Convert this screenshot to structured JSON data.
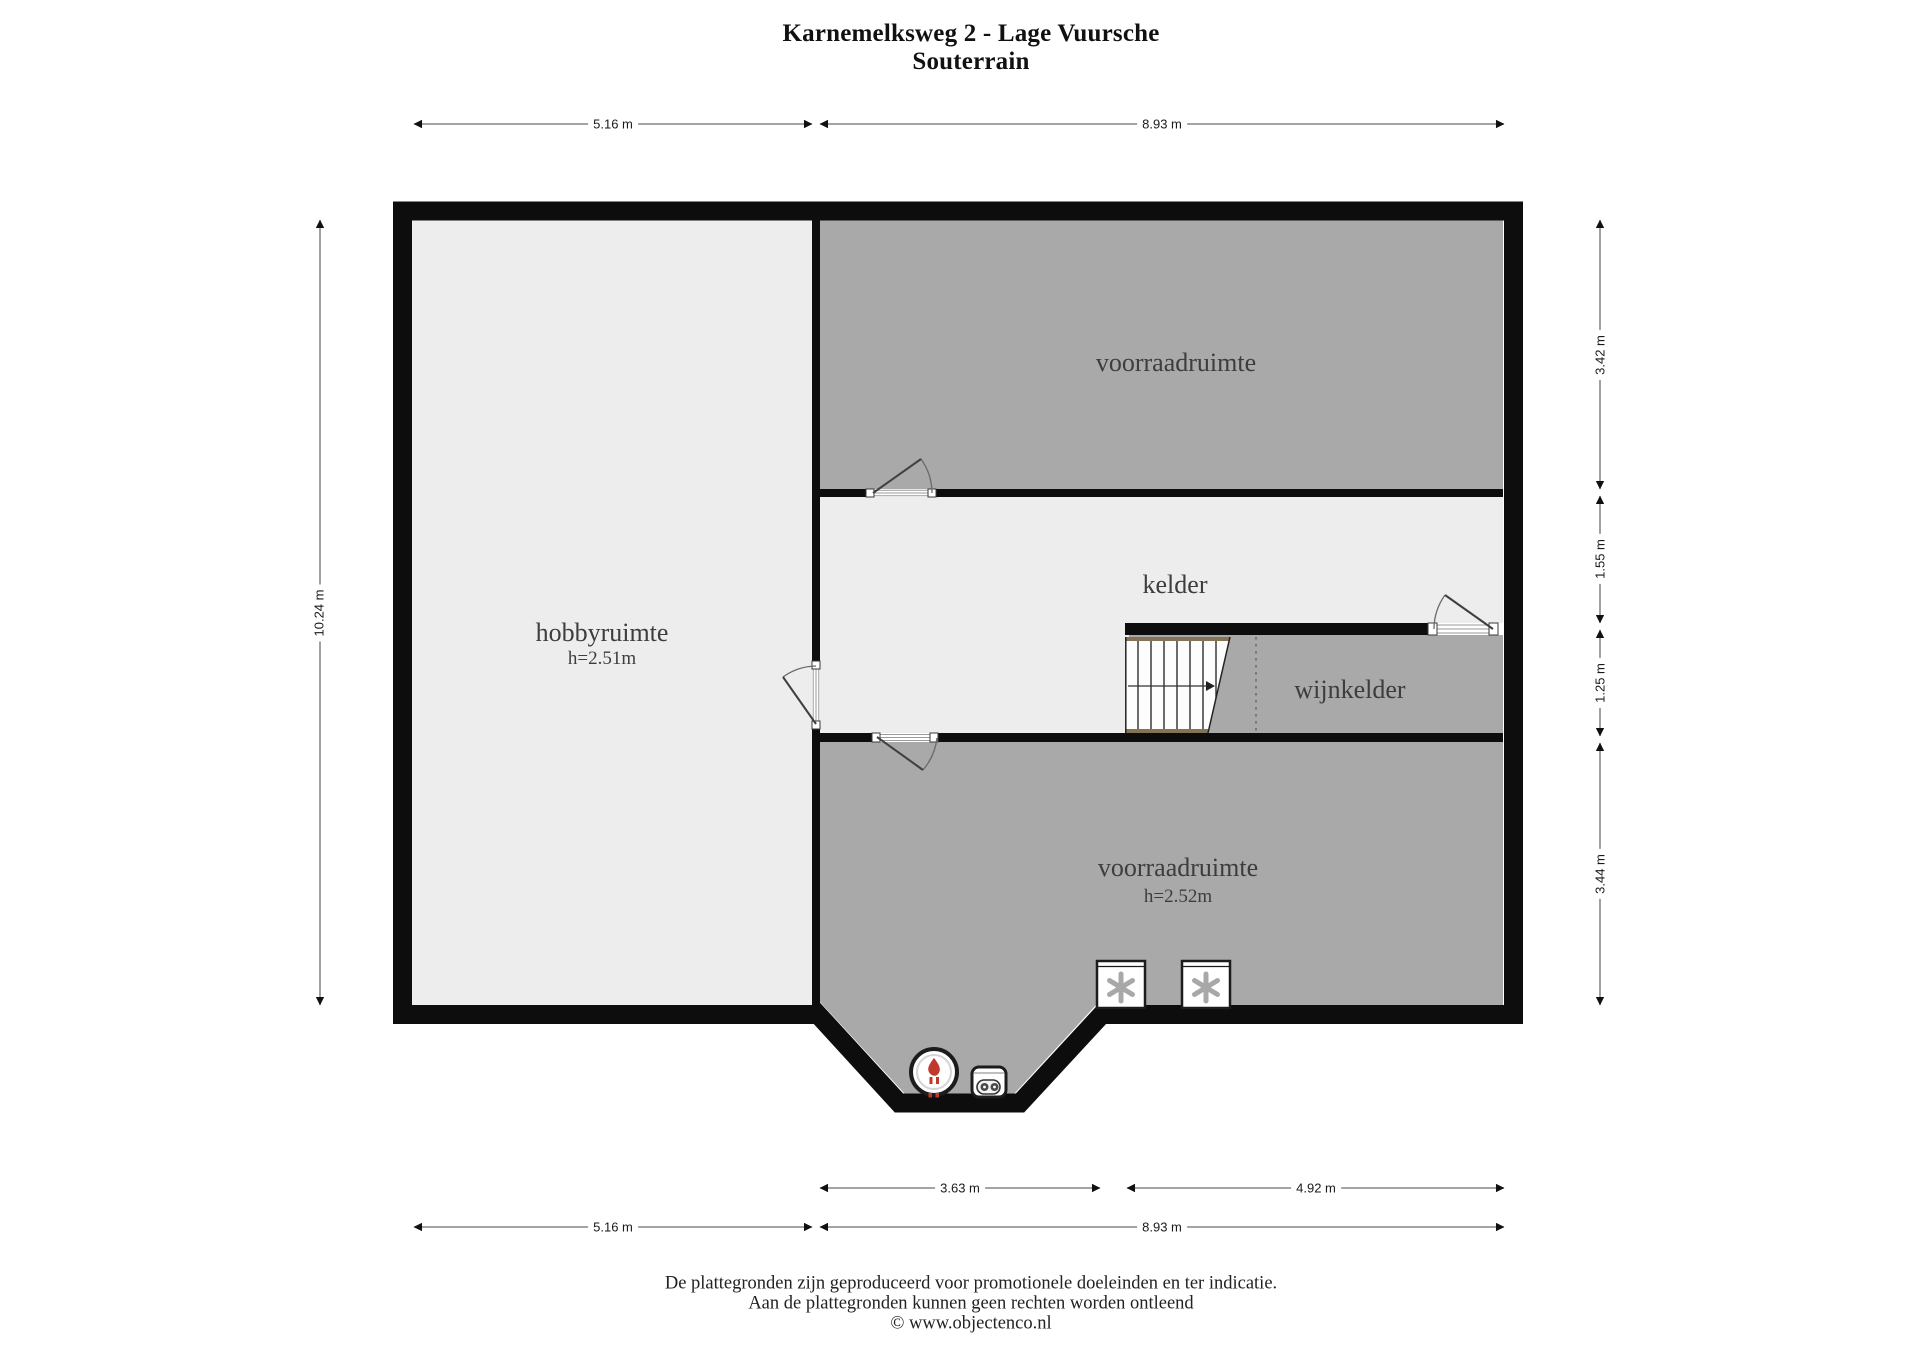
{
  "title": {
    "line1": "Karnemelksweg 2 - Lage Vuursche",
    "line2": "Souterrain"
  },
  "rooms": {
    "voorraadruimte_top": {
      "label": "voorraadruimte"
    },
    "kelder": {
      "label": "kelder"
    },
    "wijnkelder": {
      "label": "wijnkelder"
    },
    "hobbyruimte": {
      "label": "hobbyruimte",
      "ceiling_height": "h=2.51m"
    },
    "voorraadruimte_bottom": {
      "label": "voorraadruimte",
      "ceiling_height": "h=2.52m"
    }
  },
  "dimensions": {
    "top": [
      "5.16 m",
      "8.93 m"
    ],
    "bottom_row1": [
      "3.63 m",
      "4.92 m"
    ],
    "bottom_row2": [
      "5.16 m",
      "8.93 m"
    ],
    "left": "10.24 m",
    "right": [
      "3.42 m",
      "1.55 m",
      "1.25 m",
      "3.44 m"
    ]
  },
  "footer": {
    "line1": "De plattegronden zijn geproduceerd voor promotionele doeleinden en ter indicatie.",
    "line2": "Aan de plattegronden kunnen geen rechten worden ontleend",
    "line3": "© www.objectenco.nl"
  },
  "icons": {
    "boiler": "boiler-flame-icon",
    "appliance": "water-heater-icon",
    "washer": "appliance-asterisk-icon",
    "stairs": "staircase-icon"
  },
  "colors": {
    "wall": "#0d0d0d",
    "room_light": "#ededed",
    "room_gray": "#a9a9a9",
    "wood": "#857454",
    "dim": "#6e6e6e",
    "red": "#c0392b",
    "asterisk": "#a8a8a8"
  }
}
